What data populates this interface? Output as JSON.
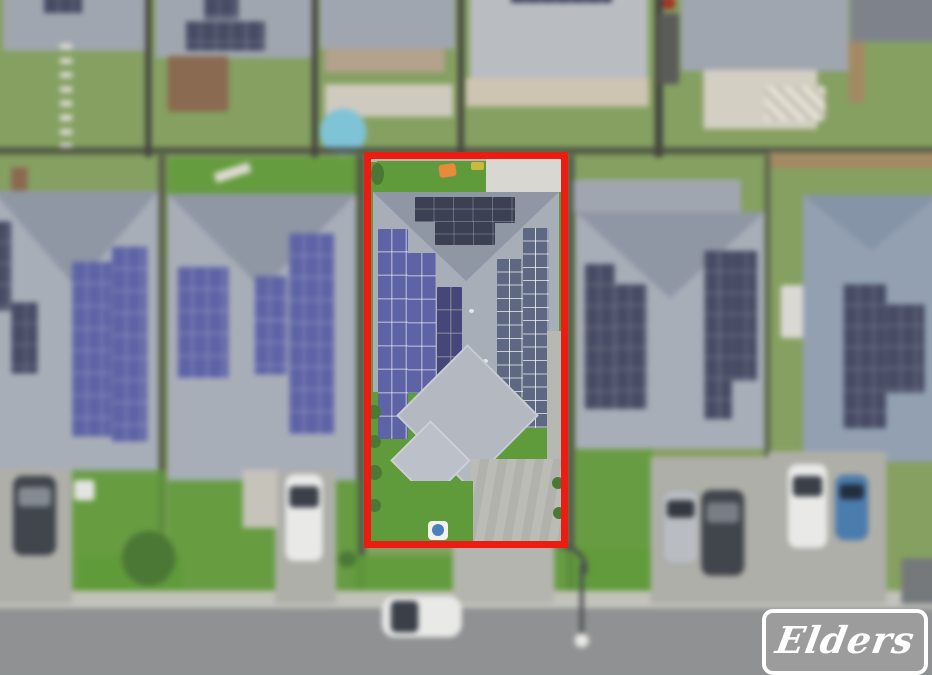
{
  "scene": {
    "description": "Aerial drone photograph of a suburban street; the for-sale property in the centre is outlined in red. Surrounding homes are blurred.",
    "highlighted_property": "two-storey-deep house with large rooftop solar arrays, rear lawn with orange cover, front lawn and concrete driveway",
    "visible_objects": "neighbouring houses with rooftop solar panels, backyards with round pool and timber deck, parked cars in driveways, white car on road, curved street light, grass verge, footpath, asphalt road"
  },
  "watermark": {
    "brand": "Elders"
  },
  "colors": {
    "lawn_muted": "#85a061",
    "lawn_bright": "#5f9b3a",
    "lawn_dark": "#4c7836",
    "roof_light": "#a8aeb8",
    "roof_mid": "#a0a6b0",
    "roof_shade": "#8f96a4",
    "roof_far_right": "#93a0b2",
    "concrete": "#d8d7d1",
    "driveway": "#afafa9",
    "footpath": "#c2c2bb",
    "road": "#8f9192",
    "panel_navy": "#3b4053",
    "panel_purple": "#5e63a5",
    "panel_blue_gray": "#5e6883",
    "panel_neighbor": "#474c64",
    "fence_dark": "#45463f",
    "fence_tan": "#a38a63",
    "pool_blue": "#7fc3d6",
    "deck_brown": "#8a6a50",
    "tarp_orange": "#e78a3a",
    "outline_red": "#ec1c12",
    "car_white": "#e9eae8",
    "car_dark": "#41454c",
    "car_silver": "#b9bdc1",
    "car_blue": "#4b7cae",
    "logo_gray": "#9c9c9c",
    "logo_white": "#ffffff"
  }
}
